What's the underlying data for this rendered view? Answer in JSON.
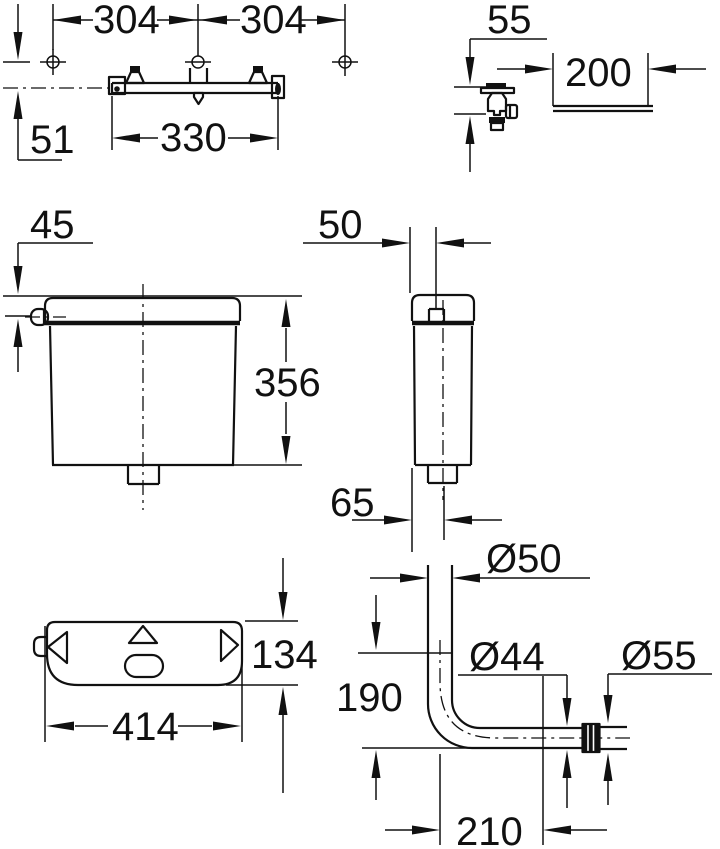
{
  "page": {
    "background": "#ffffff",
    "line_color": "#111111"
  },
  "drawing": {
    "kind": "technical dimension drawing",
    "subject": "exposed toilet cistern installation dimensions",
    "unit": "mm",
    "views": {
      "mounting_rail": {
        "label": "mounting rail with fixing holes",
        "dims": {
          "hole_spacing_left": "304",
          "hole_spacing_right": "304",
          "rail_offset": "51",
          "rail_length": "330"
        }
      },
      "supply_valve": {
        "label": "angle valve and wall clearance",
        "dims": {
          "valve_offset": "55",
          "wall_clearance": "200"
        }
      },
      "cistern_front": {
        "label": "cistern front view",
        "dims": {
          "inlet_offset": "45",
          "height": "356"
        }
      },
      "cistern_side": {
        "label": "cistern side view",
        "dims": {
          "inlet_depth": "50",
          "outlet_offset": "65"
        }
      },
      "cistern_top": {
        "label": "cistern top view",
        "dims": {
          "depth": "134",
          "width": "414"
        }
      },
      "flush_pipe": {
        "label": "flush bend pipe",
        "dims": {
          "pipe_diameter": "Ø50",
          "drop_length": "190",
          "spigot_diameter": "Ø44",
          "coupling_diameter": "Ø55",
          "horizontal_length": "210"
        }
      }
    }
  }
}
